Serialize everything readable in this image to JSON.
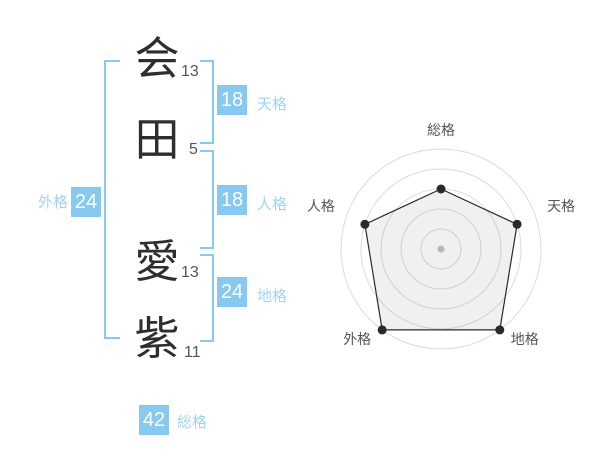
{
  "name": {
    "full": "会田 愛紫",
    "characters": [
      {
        "char": "会",
        "strokes": "13"
      },
      {
        "char": "田",
        "strokes": "5"
      },
      {
        "char": "愛",
        "strokes": "13"
      },
      {
        "char": "紫",
        "strokes": "11"
      }
    ]
  },
  "scores": {
    "tenkaku": {
      "label": "天格",
      "value": "18"
    },
    "jinkaku": {
      "label": "人格",
      "value": "18"
    },
    "chikaku": {
      "label": "地格",
      "value": "24"
    },
    "gaikaku": {
      "label": "外格",
      "value": "24"
    },
    "soukaku": {
      "label": "総格",
      "value": "42"
    }
  },
  "colors": {
    "accent_blue": "#87c9f0",
    "label_blue": "#9fd4f6",
    "badge_text": "#ffffff",
    "kanji": "#2e2e2e",
    "stroke_count": "#555555",
    "radar_label": "#555555",
    "ring": "#dcdcdc",
    "polygon_stroke": "#2a2a2a",
    "polygon_fill": "rgba(0,0,0,0.06)",
    "point": "#2a2a2a",
    "center_dot": "#c4c4c4"
  },
  "chart_data": {
    "type": "radar",
    "categories": [
      "総格",
      "天格",
      "地格",
      "外格",
      "人格"
    ],
    "values": [
      3,
      4,
      5,
      5,
      4
    ],
    "max": 5,
    "levels": 5,
    "grid": "concentric-circles",
    "grid_on": true,
    "start_angle_deg": 90,
    "direction": "clockwise",
    "legend": "none",
    "title": ""
  }
}
